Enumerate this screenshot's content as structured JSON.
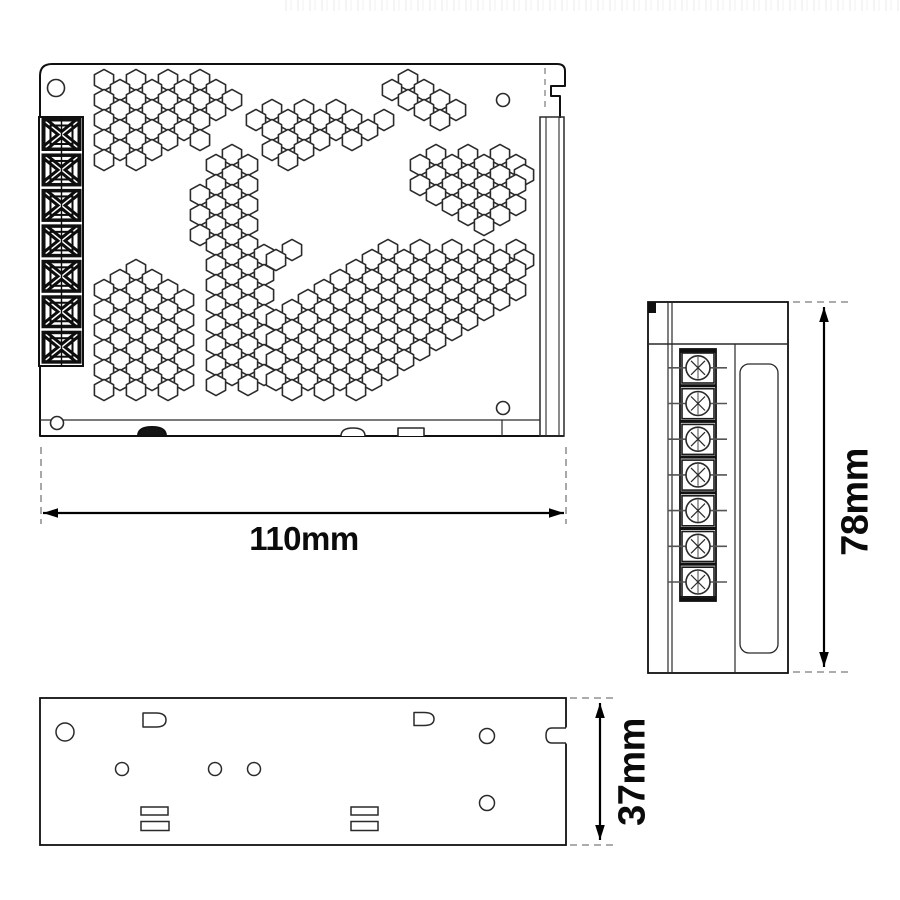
{
  "dimensions": {
    "width_label": "110mm",
    "height_label": "78mm",
    "depth_label": "37mm"
  },
  "colors": {
    "line": "#2a2a2a",
    "heavy": "#101010",
    "dim_line": "#000000",
    "dash": "#7a7a7a",
    "pin": "#555555",
    "white": "#ffffff"
  },
  "top_view": {
    "terminal_block_count": 7,
    "corner_screw_holes": [
      [
        56,
        88,
        8.5
      ],
      [
        503,
        100,
        6.5
      ],
      [
        57,
        423,
        6.5
      ],
      [
        503,
        408,
        6.5
      ]
    ],
    "hex": {
      "rx": 9.6,
      "ry": 10.6
    },
    "vent_clusters": [
      {
        "rows": [
          {
            "y": 80,
            "xs": [
              104,
              136,
              168,
              200
            ]
          },
          {
            "y": 90,
            "xs": [
              120,
              152,
              184,
              216
            ]
          },
          {
            "y": 100,
            "xs": [
              104,
              136,
              168,
              200,
              232
            ]
          },
          {
            "y": 110,
            "xs": [
              120,
              152,
              184,
              216
            ]
          },
          {
            "y": 120,
            "xs": [
              104,
              136,
              168,
              200
            ]
          },
          {
            "y": 130,
            "xs": [
              120,
              152,
              184
            ]
          },
          {
            "y": 140,
            "xs": [
              104,
              136,
              168,
              200
            ]
          },
          {
            "y": 150,
            "xs": [
              120,
              152
            ]
          },
          {
            "y": 160,
            "xs": [
              104,
              136
            ]
          }
        ]
      },
      {
        "rows": [
          {
            "y": 110,
            "xs": [
              272,
              304,
              336
            ]
          },
          {
            "y": 120,
            "xs": [
              256,
              288,
              320,
              352,
              384
            ]
          },
          {
            "y": 130,
            "xs": [
              272,
              304,
              336,
              368
            ]
          },
          {
            "y": 140,
            "xs": [
              288,
              320,
              352
            ]
          },
          {
            "y": 150,
            "xs": [
              272,
              304
            ]
          },
          {
            "y": 160,
            "xs": [
              288
            ]
          }
        ]
      },
      {
        "rows": [
          {
            "y": 80,
            "xs": [
              408
            ]
          },
          {
            "y": 90,
            "xs": [
              392,
              424
            ]
          },
          {
            "y": 100,
            "xs": [
              408,
              440
            ]
          },
          {
            "y": 110,
            "xs": [
              424,
              456
            ]
          },
          {
            "y": 120,
            "xs": [
              440
            ]
          }
        ]
      },
      {
        "rows": [
          {
            "y": 155,
            "xs": [
              436,
              468,
              500
            ]
          },
          {
            "y": 165,
            "xs": [
              420,
              452,
              484,
              516
            ]
          },
          {
            "y": 175,
            "xs": [
              436,
              468,
              500,
              524
            ]
          },
          {
            "y": 185,
            "xs": [
              420,
              452,
              484,
              516
            ]
          },
          {
            "y": 195,
            "xs": [
              436,
              468,
              500
            ]
          },
          {
            "y": 205,
            "xs": [
              452,
              484,
              516
            ]
          },
          {
            "y": 215,
            "xs": [
              468,
              500
            ]
          },
          {
            "y": 225,
            "xs": [
              484
            ]
          }
        ]
      },
      {
        "rows": [
          {
            "y": 155,
            "xs": [
              232
            ]
          },
          {
            "y": 165,
            "xs": [
              216,
              248
            ]
          },
          {
            "y": 175,
            "xs": [
              232
            ]
          },
          {
            "y": 185,
            "xs": [
              216,
              248
            ]
          },
          {
            "y": 195,
            "xs": [
              200,
              232
            ]
          },
          {
            "y": 205,
            "xs": [
              216,
              248
            ]
          },
          {
            "y": 215,
            "xs": [
              200,
              232
            ]
          },
          {
            "y": 225,
            "xs": [
              216,
              248
            ]
          },
          {
            "y": 235,
            "xs": [
              200,
              232
            ]
          },
          {
            "y": 245,
            "xs": [
              216,
              248
            ]
          },
          {
            "y": 255,
            "xs": [
              232,
              264
            ]
          },
          {
            "y": 265,
            "xs": [
              216,
              248
            ]
          },
          {
            "y": 275,
            "xs": [
              232,
              264
            ]
          },
          {
            "y": 285,
            "xs": [
              216,
              248
            ]
          },
          {
            "y": 295,
            "xs": [
              232,
              264
            ]
          },
          {
            "y": 305,
            "xs": [
              216,
              248
            ]
          },
          {
            "y": 315,
            "xs": [
              232,
              264
            ]
          },
          {
            "y": 325,
            "xs": [
              216,
              248
            ]
          },
          {
            "y": 335,
            "xs": [
              232,
              264
            ]
          },
          {
            "y": 345,
            "xs": [
              216,
              248
            ]
          },
          {
            "y": 355,
            "xs": [
              232,
              264
            ]
          },
          {
            "y": 365,
            "xs": [
              216,
              248
            ]
          },
          {
            "y": 375,
            "xs": [
              232,
              264
            ]
          },
          {
            "y": 385,
            "xs": [
              216,
              248
            ]
          }
        ]
      },
      {
        "rows": [
          {
            "y": 270,
            "xs": [
              136
            ]
          },
          {
            "y": 280,
            "xs": [
              120,
              152
            ]
          },
          {
            "y": 290,
            "xs": [
              104,
              136,
              168
            ]
          },
          {
            "y": 300,
            "xs": [
              120,
              152,
              184
            ]
          },
          {
            "y": 310,
            "xs": [
              104,
              136,
              168
            ]
          },
          {
            "y": 320,
            "xs": [
              120,
              152,
              184
            ]
          },
          {
            "y": 330,
            "xs": [
              104,
              136,
              168
            ]
          },
          {
            "y": 340,
            "xs": [
              120,
              152,
              184
            ]
          },
          {
            "y": 350,
            "xs": [
              104,
              136,
              168
            ]
          },
          {
            "y": 360,
            "xs": [
              120,
              152,
              184
            ]
          },
          {
            "y": 370,
            "xs": [
              104,
              136,
              168
            ]
          },
          {
            "y": 380,
            "xs": [
              120,
              152,
              184
            ]
          },
          {
            "y": 390,
            "xs": [
              104,
              136,
              168
            ]
          }
        ]
      },
      {
        "rows": [
          {
            "y": 250,
            "xs": [
              292,
              388,
              420,
              452,
              484,
              516
            ]
          },
          {
            "y": 260,
            "xs": [
              276,
              372,
              404,
              436,
              468,
              500,
              524
            ]
          },
          {
            "y": 270,
            "xs": [
              356,
              388,
              420,
              452,
              484,
              516
            ]
          },
          {
            "y": 280,
            "xs": [
              340,
              372,
              404,
              436,
              468,
              500
            ]
          },
          {
            "y": 290,
            "xs": [
              324,
              356,
              388,
              420,
              452,
              484,
              516
            ]
          },
          {
            "y": 300,
            "xs": [
              308,
              340,
              372,
              404,
              436,
              468,
              500
            ]
          },
          {
            "y": 310,
            "xs": [
              292,
              324,
              356,
              388,
              420,
              452,
              484
            ]
          },
          {
            "y": 320,
            "xs": [
              276,
              308,
              340,
              372,
              404,
              436,
              468
            ]
          },
          {
            "y": 330,
            "xs": [
              292,
              324,
              356,
              388,
              420,
              452
            ]
          },
          {
            "y": 340,
            "xs": [
              276,
              308,
              340,
              372,
              404,
              436
            ]
          },
          {
            "y": 350,
            "xs": [
              292,
              324,
              356,
              388,
              420
            ]
          },
          {
            "y": 360,
            "xs": [
              276,
              308,
              340,
              372,
              404
            ]
          },
          {
            "y": 370,
            "xs": [
              292,
              324,
              356,
              388
            ]
          },
          {
            "y": 380,
            "xs": [
              276,
              308,
              340,
              372
            ]
          },
          {
            "y": 390,
            "xs": [
              292,
              324,
              356
            ]
          }
        ]
      }
    ]
  },
  "side_view": {
    "screw_terminal_count": 7
  },
  "bottom_view": {
    "holes": [
      [
        65,
        732,
        9
      ],
      [
        122,
        769,
        6.5
      ],
      [
        215,
        769,
        6.5
      ],
      [
        254,
        769,
        6.5
      ],
      [
        487,
        736,
        7.5
      ],
      [
        487,
        803,
        7.5
      ]
    ],
    "d_slots": [
      [
        143,
        713,
        23,
        14
      ],
      [
        414,
        712.5,
        20,
        13
      ]
    ],
    "rect_slots": [
      [
        141,
        807,
        27,
        8
      ],
      [
        141,
        821.5,
        28,
        9
      ],
      [
        351,
        807,
        27,
        8
      ],
      [
        351,
        821.5,
        27,
        9
      ]
    ]
  }
}
